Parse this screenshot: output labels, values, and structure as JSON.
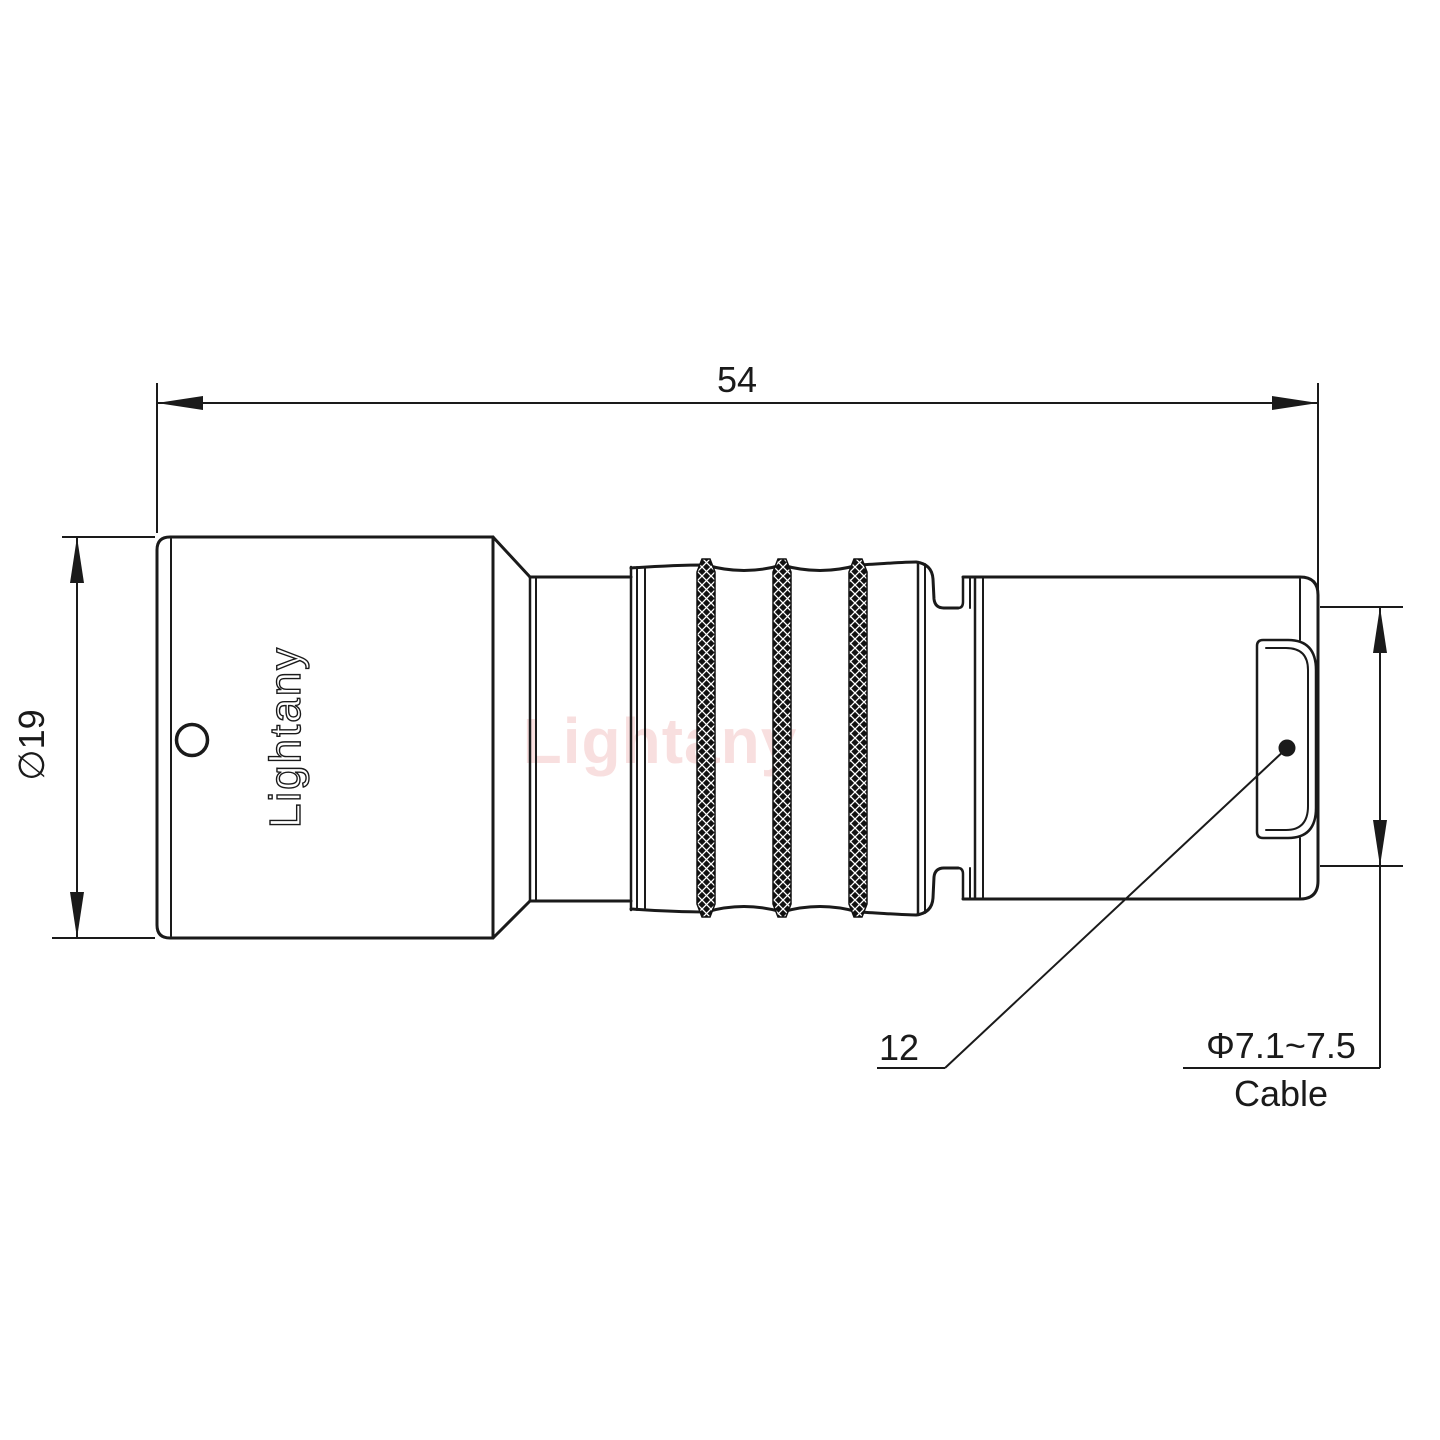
{
  "drawing": {
    "type": "connector-technical-drawing",
    "brand": {
      "logo_text": "Lightany",
      "watermark_text": "Lightany"
    },
    "dimensions": {
      "overall_length": "54",
      "body_diameter": "∅19",
      "connector_ref": "12",
      "cable_diameter_range": "Φ7.1~7.5",
      "cable_label": "Cable"
    },
    "colors": {
      "line": "#1a1a1a",
      "watermark": "#f3c6c6",
      "background": "#ffffff"
    }
  }
}
